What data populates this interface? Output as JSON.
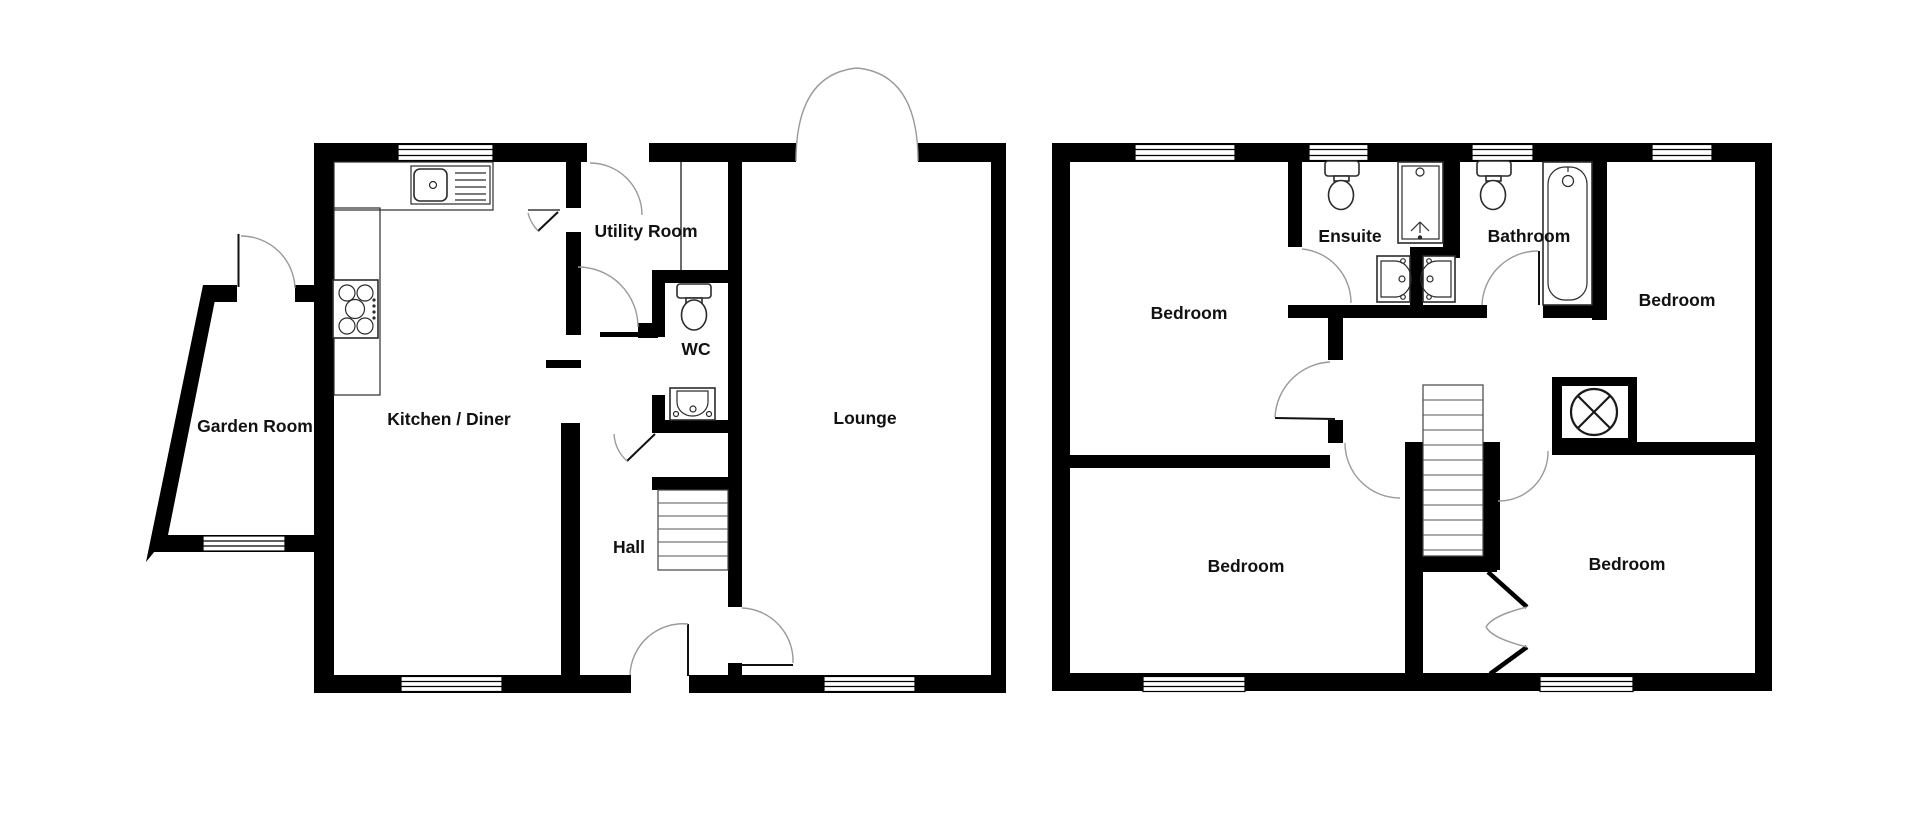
{
  "diagram": {
    "type": "floorplan",
    "colors": {
      "wall": "#000000",
      "background": "#ffffff",
      "door_swing": "#9a9a9a",
      "fixture_outline": "#2b2b2b",
      "label_text": "#111111"
    },
    "ground_floor": {
      "rooms": {
        "garden_room": {
          "label": "Garden Room"
        },
        "kitchen_diner": {
          "label": "Kitchen / Diner"
        },
        "utility_room": {
          "label": "Utility Room"
        },
        "wc": {
          "label": "WC"
        },
        "hall": {
          "label": "Hall"
        },
        "lounge": {
          "label": "Lounge"
        }
      },
      "fixtures": [
        "kitchen-sink",
        "hob",
        "toilet",
        "basin",
        "stairs",
        "windows",
        "doors",
        "french-doors"
      ]
    },
    "first_floor": {
      "rooms": {
        "bedroom_top_left": {
          "label": "Bedroom"
        },
        "ensuite": {
          "label": "Ensuite"
        },
        "bathroom": {
          "label": "Bathroom"
        },
        "bedroom_top_right": {
          "label": "Bedroom"
        },
        "bedroom_bottom_left": {
          "label": "Bedroom"
        },
        "bedroom_bottom_right": {
          "label": "Bedroom"
        }
      },
      "fixtures": [
        "toilet",
        "shower",
        "bathtub",
        "basins",
        "stairs",
        "wardrobe-cupboard",
        "bifold-door",
        "windows",
        "doors"
      ]
    }
  }
}
